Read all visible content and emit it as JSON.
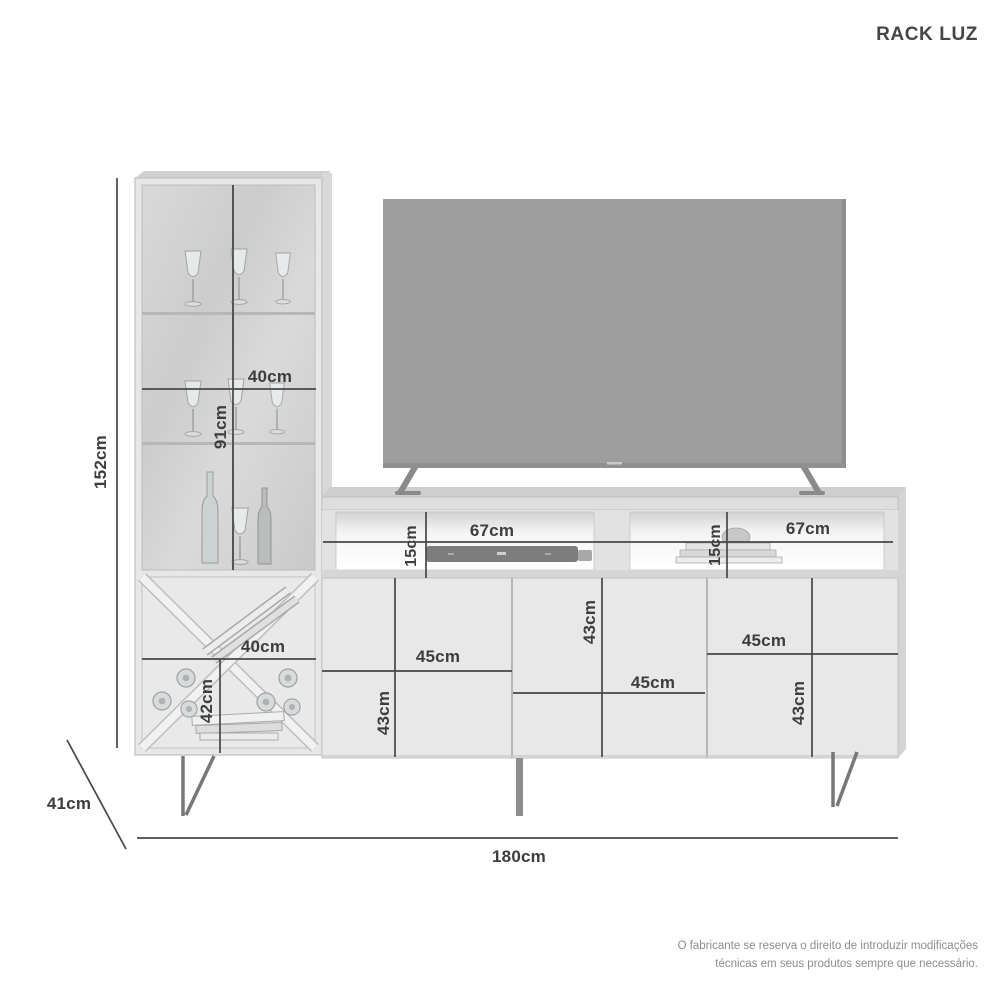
{
  "title": "RACK LUZ",
  "product_type": "tv-rack-dimension-diagram",
  "dimensions": {
    "total_height": "152cm",
    "total_width": "180cm",
    "depth": "41cm",
    "display_cabinet": {
      "upper_width": "40cm",
      "glass_height": "91cm",
      "lower_width": "40cm",
      "wine_rack_height": "42cm"
    },
    "open_shelves": {
      "left_width": "67cm",
      "left_height": "15cm",
      "right_width": "67cm",
      "right_height": "15cm"
    },
    "doors": {
      "left_width": "45cm",
      "left_height": "43cm",
      "middle_width": "45cm",
      "middle_height": "43cm",
      "right_width": "45cm",
      "right_height": "43cm"
    }
  },
  "disclaimer": {
    "line1": "O fabricante se reserva o direito de introduzir modificações",
    "line2": "técnicas em seus produtos sempre que necessário."
  },
  "colors": {
    "background": "#ffffff",
    "furniture_light": "#e7e7e7",
    "glass": "#d4d4d4",
    "tv_screen": "#9d9d9d",
    "dimension_line": "#474747",
    "dimension_text": "#3d3d3d",
    "disclaimer_text": "#8c8c8c"
  }
}
